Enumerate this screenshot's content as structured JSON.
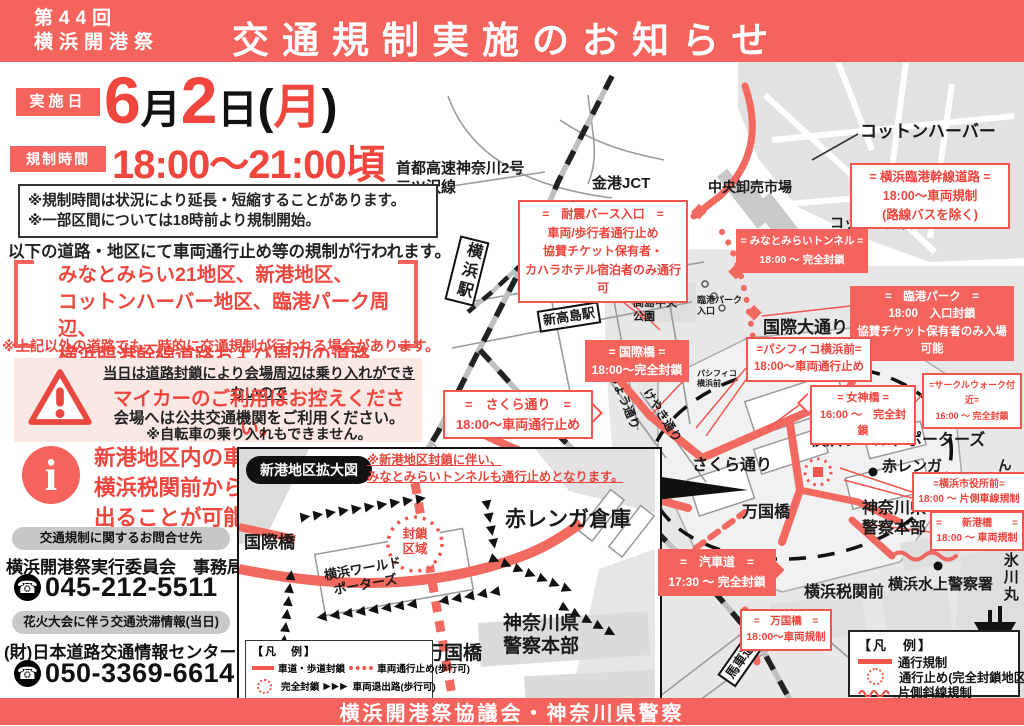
{
  "header": {
    "edition_line1": "第44回",
    "edition_line2": "横浜開港祭",
    "title": "交通規制実施のお知らせ"
  },
  "schedule": {
    "date_label": "実施日",
    "time_label": "規制時間",
    "date_parts": [
      "6",
      "月",
      "2",
      "日",
      "(",
      "月",
      ")"
    ],
    "time": "18:00〜21:00頃"
  },
  "notice_box": {
    "line1": "※規制時間は状況により延長・短縮することがあります。",
    "line2": "※一部区間については18時前より規制開始。"
  },
  "intro": "以下の道路・地区にて車両通行止め等の規制が行われます。",
  "districts": {
    "lines": "みなとみらい21地区、新港地区、\nコットンハーバー地区、臨港パーク周辺、\n横浜臨港幹線道路および周辺の道路",
    "note": "※上記以外の道路でも一時的に交通規制が行われる場合があります。"
  },
  "warning": {
    "line1": "当日は道路封鎖により会場周辺は乗り入れができないので",
    "line2": "マイカーのご利用はお控えください。",
    "line3": "会場へは公共交通機関をご利用ください。",
    "line4": "※自転車の乗り入れもできません。"
  },
  "info_note": "新港地区内の車両は\n横浜税関前からのみ\n出ることが可能です。",
  "contacts": [
    {
      "pill": "交通規制に関するお問合せ先",
      "org": "横浜開港祭実行委員会　事務局",
      "phone": "045-212-5511"
    },
    {
      "pill": "花火大会に伴う交通渋滞情報(当日)",
      "org": "(財)日本道路交通情報センター",
      "phone": "050-3369-6614"
    }
  ],
  "footer": "横浜開港祭協議会・神奈川県警察",
  "icons": {
    "phone": "☎",
    "info": "i",
    "arrows": "▶▶▶"
  },
  "map": {
    "labels": [
      {
        "text": "首都高速神奈川2号\n三ツ沢線"
      },
      {
        "text": "金港JCT"
      },
      {
        "text": "中央卸売市場"
      },
      {
        "text": "コットンハーバー"
      },
      {
        "text": "コットン大橋"
      },
      {
        "text": "横浜駅"
      },
      {
        "text": "とちのき通り"
      },
      {
        "text": "新高島駅"
      },
      {
        "text": "高島中央\n公園"
      },
      {
        "text": "臨港パーク\n入口"
      },
      {
        "text": "国際大通り"
      },
      {
        "text": "パシフィコ\n横浜前"
      },
      {
        "text": "いちょう通り"
      },
      {
        "text": "けやき通り"
      },
      {
        "text": "さくら通り"
      },
      {
        "text": "横浜ワールドポーターズ"
      },
      {
        "text": "赤レンガ"
      },
      {
        "text": "ん橋"
      },
      {
        "text": "万国橋"
      },
      {
        "text": "神奈川県\n警察本部"
      },
      {
        "text": "横浜税関前"
      },
      {
        "text": "横浜水上警察署"
      },
      {
        "text": "氷川丸"
      },
      {
        "text": "馬車道"
      },
      {
        "text": "大通り"
      }
    ],
    "callouts": [
      {
        "lines": [
          "=　耐震バース入口　=",
          "車両/歩行者通行止め",
          "協賛チケット保有者・",
          "カハラホテル宿泊者のみ通行可"
        ]
      },
      {
        "lines": [
          "= 横浜臨港幹線道路 =",
          "18:00〜車両規制",
          "(路線バスを除く)"
        ]
      },
      {
        "lines": [
          "= みなとみらいトンネル =",
          "18:00 〜 完全封鎖"
        ]
      },
      {
        "lines": [
          "=　臨港パーク　=",
          "18:00　入口封鎖",
          "協賛チケット保有者のみ入場可能"
        ]
      },
      {
        "lines": [
          "= 国際橋 =",
          "18:00〜完全封鎖"
        ]
      },
      {
        "lines": [
          "=パシフィコ横浜前=",
          "18:00〜車両通行止め"
        ]
      },
      {
        "lines": [
          "= 女神橋 =",
          "16:00 〜　完全封鎖"
        ]
      },
      {
        "lines": [
          "=サークルウォーク付近=",
          "16:00 〜 完全封鎖"
        ]
      },
      {
        "lines": [
          "=　さくら通り　=",
          "18:00〜車両通行止め"
        ]
      },
      {
        "lines": [
          "=横浜市役所前=",
          "18:00 〜 片側車線規制"
        ]
      },
      {
        "lines": [
          "=　　新港橋　　=",
          "18:00 〜 車両規制"
        ]
      },
      {
        "lines": [
          "=　汽車道　=",
          "17:30 〜 完全封鎖"
        ]
      },
      {
        "lines": [
          "=　万国橋　=",
          "18:00〜車両規制"
        ]
      }
    ],
    "legend": {
      "title": "【凡　例】",
      "item1": "通行規制",
      "item2": "通行止め(完全封鎖地区)",
      "item3": "片側斜線規制"
    }
  },
  "inset": {
    "title": "新港地区拡大図",
    "note": "※新港地区封鎖に伴い、\nみなとみらいトンネルも通行止めとなります。",
    "labels": [
      {
        "text": "国際橋"
      },
      {
        "text": "封鎖\n区域"
      },
      {
        "text": "横浜ワールド\nポーターズ"
      },
      {
        "text": "赤レンガ倉庫"
      },
      {
        "text": "万国橋"
      },
      {
        "text": "神奈川県\n警察本部"
      }
    ],
    "legend": {
      "title": "【凡　例】",
      "item1": "車道・歩道封鎖",
      "item2": "車両通行止め(歩行可)",
      "item3": "完全封鎖",
      "item4": "車両退出路(歩行可)"
    }
  }
}
